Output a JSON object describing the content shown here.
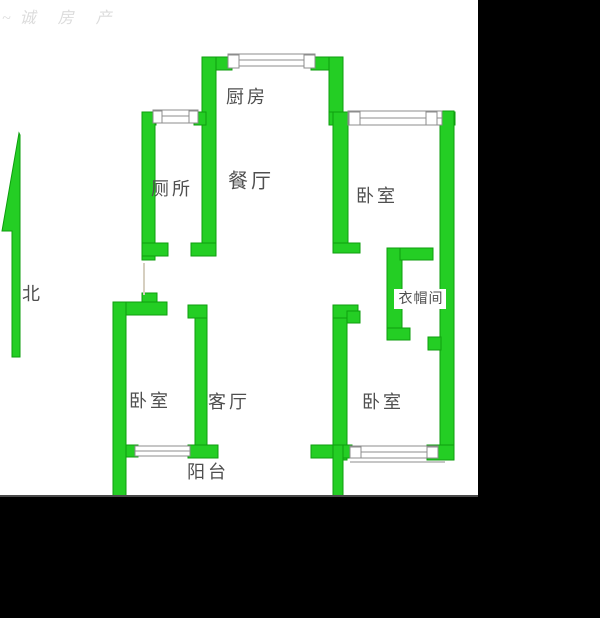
{
  "watermark": "~诚 房 产",
  "north": {
    "label": "北"
  },
  "rooms": {
    "kitchen": {
      "label": "厨房"
    },
    "toilet": {
      "label": "厕所"
    },
    "dining": {
      "label": "餐厅"
    },
    "bedroom_ne": {
      "label": "卧室"
    },
    "cloakroom": {
      "label": "衣帽间"
    },
    "bedroom_sw": {
      "label": "卧室"
    },
    "living": {
      "label": "客厅"
    },
    "bedroom_se": {
      "label": "卧室"
    },
    "balcony": {
      "label": "阳台"
    }
  },
  "colors": {
    "wall": "#24CE24",
    "wall_edge": "#0E9E0E",
    "window_line": "#8C8C8C",
    "window_fill": "#FFFFFF",
    "label": "#4F4F4F",
    "watermark": "#DCDCDC",
    "door_line": "#D6CFC0",
    "background": "#FFFFFF",
    "mask": "#000000"
  }
}
